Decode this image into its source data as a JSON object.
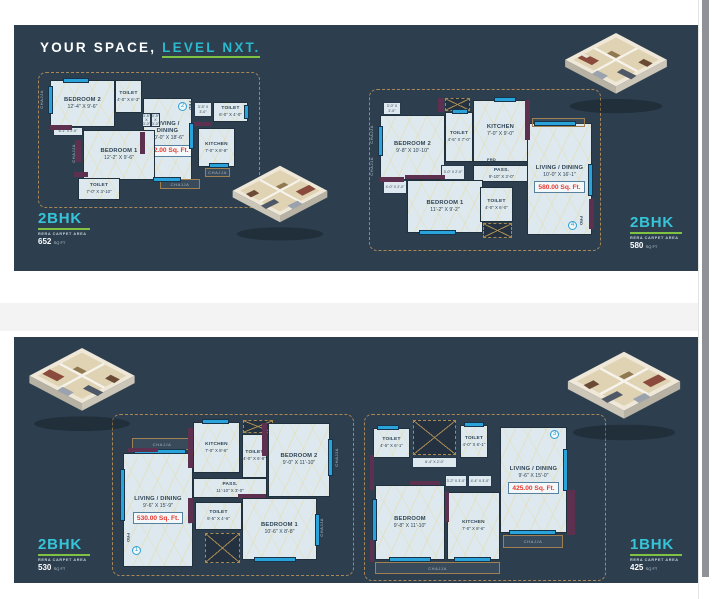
{
  "header": {
    "title": "YOUR SPACE, ",
    "accent": "LEVEL NXT."
  },
  "labels": {
    "frd": "FRD",
    "prd": "PRD",
    "chajja": "CHAJJA",
    "pass": "PASS."
  },
  "colors": {
    "panel": "#2d3f4f",
    "accent_cyan": "#2ab9cd",
    "underline_green": "#7fc243",
    "area_red": "#e7392e",
    "window_blue": "#2aa2da",
    "wall_maroon": "#5d3050"
  },
  "plans": [
    {
      "id": "plan-652",
      "marker": "2",
      "area_label": "652.00 Sq. Ft.",
      "rooms": [
        {
          "name": "BEDROOM 2",
          "dims": "12'-4\" X 9'-6\""
        },
        {
          "name": "TOILET",
          "dims": "4'-0\" X 6'-3\""
        },
        {
          "name": "LIVING / DINING",
          "dims": "10'-0\" X 18'-6\""
        },
        {
          "name": "BEDROOM 1",
          "dims": "12'-2\" X 9'-6\""
        },
        {
          "name": "TOILET",
          "dims": "7'-0\" X 3'-10\""
        },
        {
          "name": "TOILET",
          "dims": "6'-0\" X 4'-0\""
        },
        {
          "name": "KITCHEN",
          "dims": "7'-0\" X 8'-8\""
        }
      ],
      "small_dims": [
        "3'-5\" X 3'-0\"",
        "3'-5\" X 3'-0\"",
        "6'-1\" X 2'-0\"",
        "3'-5\" X 3'-0\""
      ]
    },
    {
      "id": "plan-580",
      "marker": "4",
      "area_label": "580.00 Sq. Ft.",
      "rooms": [
        {
          "name": "BEDROOM 2",
          "dims": "9'-8\" X 10'-10\""
        },
        {
          "name": "TOILET",
          "dims": "4'-5\" X 7'-0\""
        },
        {
          "name": "KITCHEN",
          "dims": "7'-0\" X 9'-0\""
        },
        {
          "name": "PASS.",
          "dims": "9'-10\" X 3'-0\""
        },
        {
          "name": "BEDROOM 1",
          "dims": "11'-2\" X 9'-2\""
        },
        {
          "name": "TOILET",
          "dims": "4'-0\" X 6'-0\""
        },
        {
          "name": "LIVING / DINING",
          "dims": "10'-0\" X 16'-1\""
        }
      ],
      "small_dims": [
        "3'-0\" X 2'-0\"",
        "3'-0\" X 2'-0\"",
        "4'-0\" X 2'-0\"",
        "9'-4\" X 3'-0\""
      ]
    },
    {
      "id": "plan-530",
      "marker": "1",
      "area_label": "530.00 Sq. Ft.",
      "rooms": [
        {
          "name": "KITCHEN",
          "dims": "7'-0\" X 8'-6\""
        },
        {
          "name": "TOILET",
          "dims": "4'-0\" X 6'-8\""
        },
        {
          "name": "BEDROOM 2",
          "dims": "9'-0\" X 11'-10\""
        },
        {
          "name": "LIVING / DINING",
          "dims": "9'-6\" X 15'-9\""
        },
        {
          "name": "PASS.",
          "dims": "11'-10\" X 3'-0\""
        },
        {
          "name": "TOILET",
          "dims": "5'-5\" X 4'-6\""
        },
        {
          "name": "BEDROOM 1",
          "dims": "10'-6\" X 8'-8\""
        }
      ],
      "small_dims": [
        "9'-0\" X 1'-6\""
      ]
    },
    {
      "id": "plan-425",
      "marker": "3",
      "area_label": "425.00 Sq. Ft.",
      "rooms": [
        {
          "name": "TOILET",
          "dims": "4'-5\" X 6'-1\""
        },
        {
          "name": "TOILET",
          "dims": "4'-0\" X 6'-1\""
        },
        {
          "name": "LIVING / DINING",
          "dims": "9'-6\" X 15'-0\""
        },
        {
          "name": "BEDROOM",
          "dims": "9'-8\" X 11'-10\""
        },
        {
          "name": "KITCHEN",
          "dims": "7'-0\" X 8'-6\""
        }
      ],
      "small_dims": [
        "6'-4\" X 2'-0\"",
        "3'-2\" X 3'-0\"",
        "4'-4\" X 3'-0\"",
        "6'-5\" X 1'-7\""
      ]
    }
  ],
  "badges": [
    {
      "type": "2BHK",
      "note": "RERA CARPET AREA",
      "area": "652",
      "unit": "SQ FT"
    },
    {
      "type": "2BHK",
      "note": "RERA CARPET AREA",
      "area": "580",
      "unit": "SQ FT"
    },
    {
      "type": "2BHK",
      "note": "RERA CARPET AREA",
      "area": "530",
      "unit": "SQ FT"
    },
    {
      "type": "1BHK",
      "note": "RERA CARPET AREA",
      "area": "425",
      "unit": "SQ FT"
    }
  ]
}
